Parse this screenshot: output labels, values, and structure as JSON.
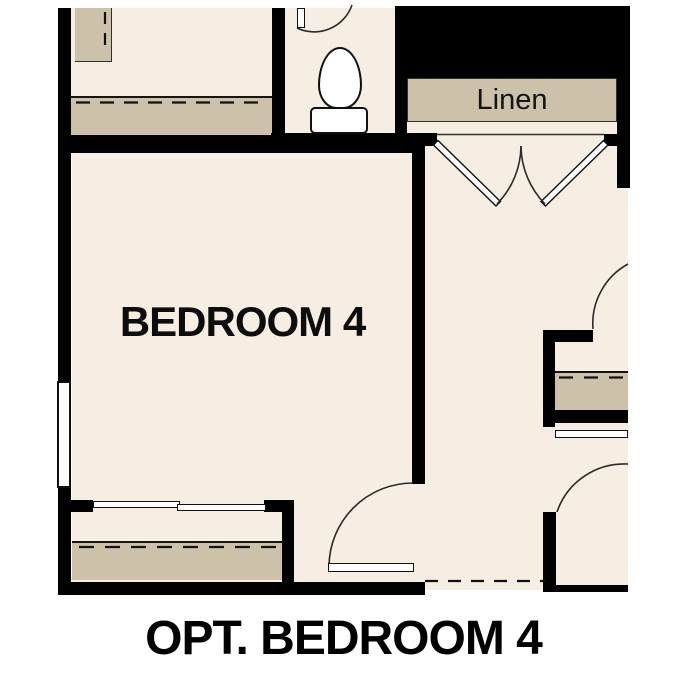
{
  "plan": {
    "type": "floor-plan",
    "room_label": "BEDROOM 4",
    "linen_label": "Linen",
    "caption": "OPT. BEDROOM 4",
    "fixtures": [
      "toilet",
      "window",
      "linen-double-doors",
      "bypass-closet-doors",
      "swing-door",
      "optional-wall-dashed-line",
      "closet-shelf"
    ]
  },
  "colors": {
    "page": "#ffffff",
    "floor": "#f6eee3",
    "cabinet": "#cdc1aa",
    "wall": "#000000",
    "text": "#0d0d0d"
  }
}
